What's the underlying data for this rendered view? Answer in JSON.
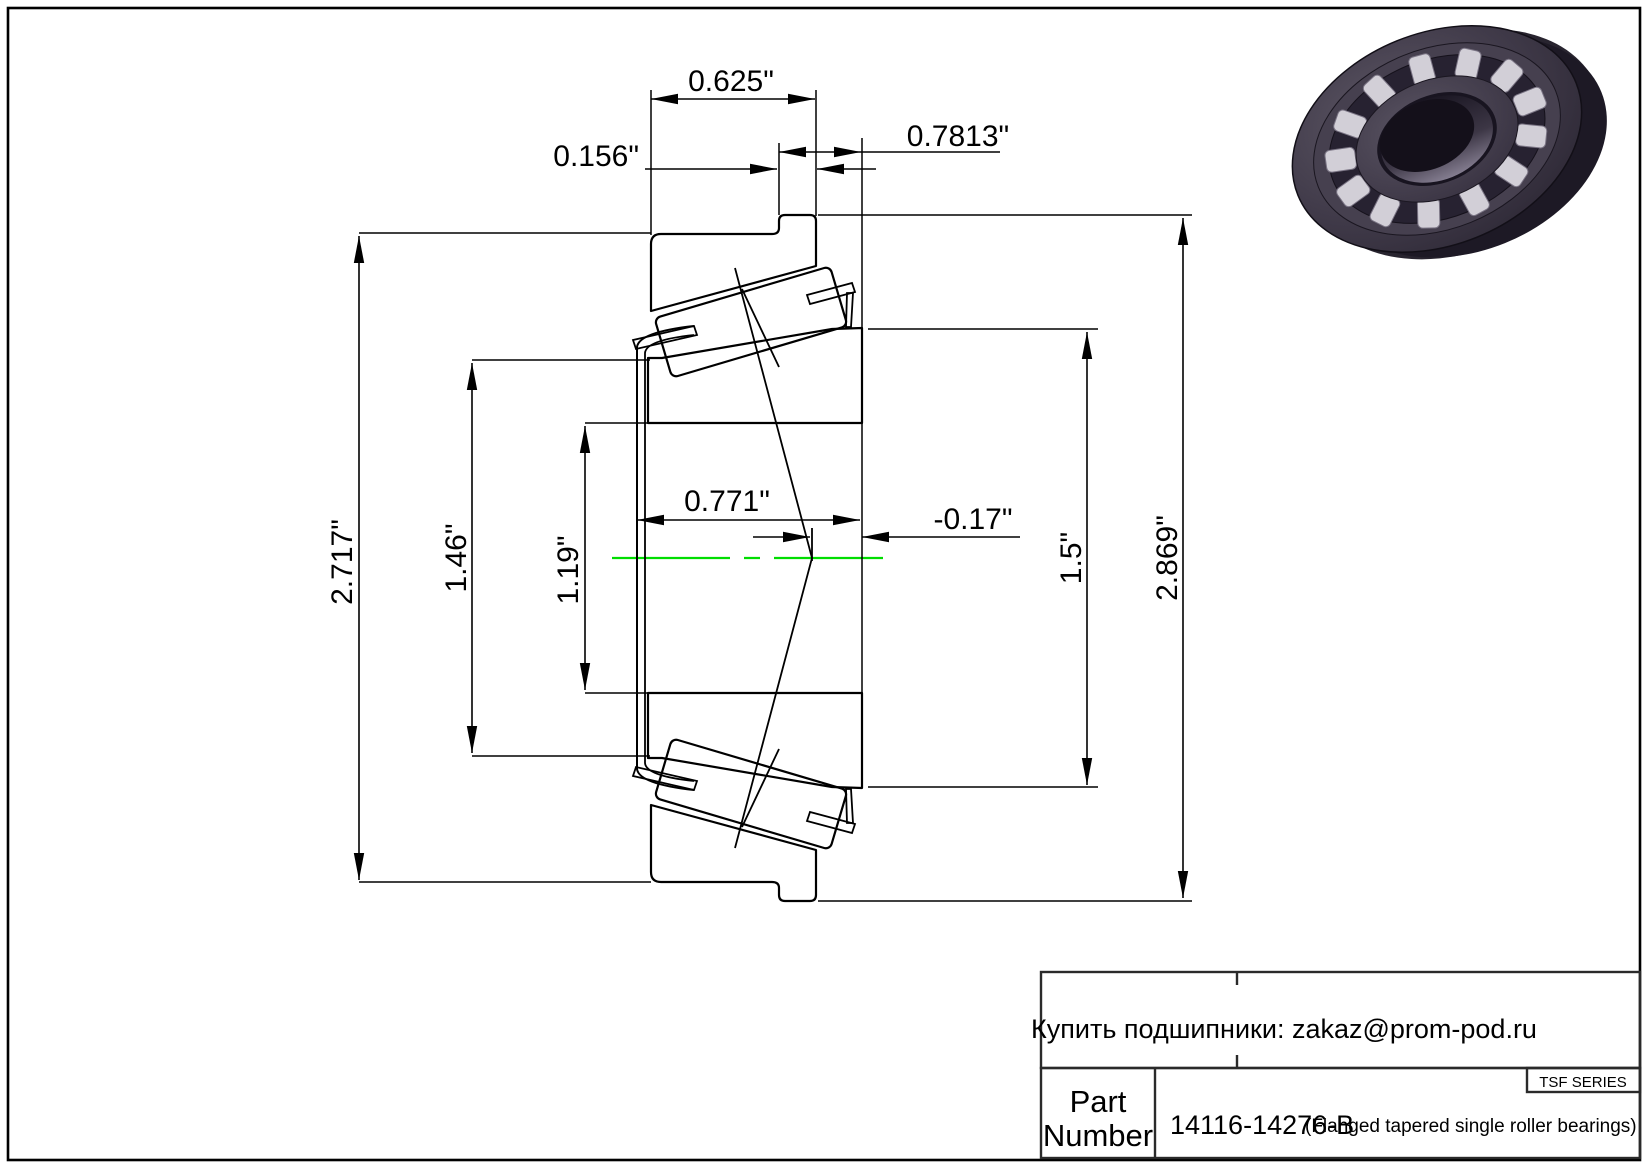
{
  "drawing": {
    "dimensions": {
      "cup_width": "0.625\"",
      "flange_width": "0.156\"",
      "overall_width": "0.7813\"",
      "cone_width": "0.771\"",
      "effective_load_center": "-0.17\"",
      "cup_od": "2.717\"",
      "cage_od": "1.46\"",
      "bore_diameter": "1.19\"",
      "rib_od": "1.5\"",
      "flange_od": "2.869\""
    },
    "centerline_color": "#00dd00"
  },
  "title_block": {
    "contact": "Купить подшипники: zakaz@prom-pod.ru",
    "series": "TSF SERIES",
    "part_label": {
      "line1": "Part",
      "line2": "Number"
    },
    "part_number": "14116-14276-B",
    "part_description": "(Flanged tapered single roller bearings)"
  }
}
